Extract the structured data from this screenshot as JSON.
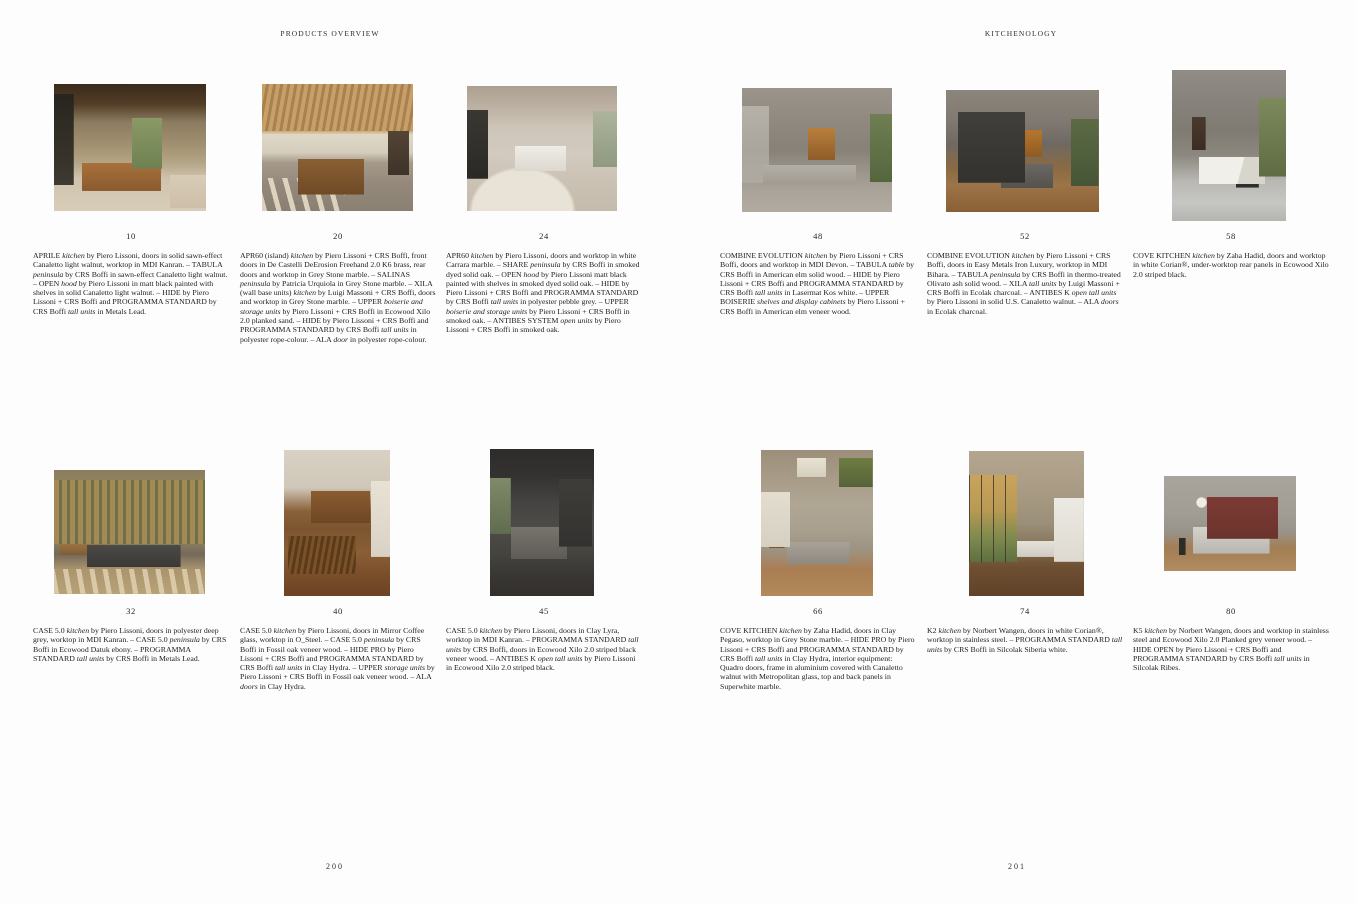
{
  "spread": {
    "page_left": {
      "header": "PRODUCTS OVERVIEW",
      "page_number": "200",
      "items": [
        {
          "number": "10",
          "photo_desc": "kitchen with dark wood ceiling, walnut island, greenery through window",
          "caption": [
            {
              "t": "APRILE "
            },
            {
              "t": "kitchen",
              "i": true
            },
            {
              "t": " by Piero Lissoni, doors in solid sawn-effect Canaletto light walnut, worktop in MDI Kanran. – TABULA "
            },
            {
              "t": "peninsula",
              "i": true
            },
            {
              "t": " by CRS Boffi in sawn-effect Canaletto light walnut. – OPEN "
            },
            {
              "t": "hood",
              "i": true
            },
            {
              "t": " by Piero Lissoni in matt black painted with shelves in solid Canaletto light walnut. – HIDE by Piero Lissoni + CRS Boffi and PROGRAMMA STANDARD by CRS Boffi "
            },
            {
              "t": "tall units",
              "i": true
            },
            {
              "t": " in Metals Lead."
            }
          ]
        },
        {
          "number": "20",
          "photo_desc": "kitchen under wooden slat ceiling with stone island and sunlit floor",
          "caption": [
            {
              "t": "APR60 (island) "
            },
            {
              "t": "kitchen",
              "i": true
            },
            {
              "t": " by Piero Lissoni + CRS Boffi, front doors in De Castelli DeErosion Freehand 2.0 K6 brass, rear doors and worktop in Grey Stone marble. – SALINAS "
            },
            {
              "t": "peninsula",
              "i": true
            },
            {
              "t": " by Patricia Urquiola in Grey Stone marble. – XILA (wall base units) "
            },
            {
              "t": "kitchen",
              "i": true
            },
            {
              "t": " by Luigi Massoni + CRS Boffi, doors and worktop in Grey Stone marble. – UPPER "
            },
            {
              "t": "boiserie and storage units",
              "i": true
            },
            {
              "t": " by Piero Lissoni + CRS Boffi in Ecowood Xilo 2.0 planked sand. – HIDE by Piero Lissoni + CRS Boffi and PROGRAMMA STANDARD by CRS Boffi "
            },
            {
              "t": "tall units",
              "i": true
            },
            {
              "t": " in polyester rope-colour. – ALA "
            },
            {
              "t": "door",
              "i": true
            },
            {
              "t": " in polyester rope-colour."
            }
          ]
        },
        {
          "number": "24",
          "photo_desc": "living kitchen in white Carrara marble with curved cream sofas",
          "caption": [
            {
              "t": "APR60 "
            },
            {
              "t": "kitchen",
              "i": true
            },
            {
              "t": " by Piero Lissoni, doors and worktop in white Carrara marble. – SHARE "
            },
            {
              "t": "peninsula",
              "i": true
            },
            {
              "t": " by CRS Boffi in smoked dyed solid oak. – OPEN "
            },
            {
              "t": "hood",
              "i": true
            },
            {
              "t": " by Piero Lissoni matt black painted with shelves in smoked dyed solid oak. – HIDE by Piero Lissoni + CRS Boffi and PROGRAMMA STANDARD by CRS Boffi "
            },
            {
              "t": "tall units",
              "i": true
            },
            {
              "t": " in polyester pebble grey. – UPPER "
            },
            {
              "t": "boiserie and storage units",
              "i": true
            },
            {
              "t": " by Piero Lissoni + CRS Boffi in smoked oak. – ANTIBES SYSTEM "
            },
            {
              "t": "open units",
              "i": true
            },
            {
              "t": " by Piero Lissoni + CRS Boffi in smoked oak."
            }
          ]
        },
        {
          "number": "32",
          "photo_desc": "kitchen behind wooden slat screens with greenery and dark island",
          "caption": [
            {
              "t": "CASE 5.0 "
            },
            {
              "t": "kitchen",
              "i": true
            },
            {
              "t": " by Piero Lissoni, doors in polyester deep grey, worktop in MDI Kanran. – CASE 5.0 "
            },
            {
              "t": "peninsula",
              "i": true
            },
            {
              "t": " by CRS Boffi in Ecowood Datuk ebony. – PROGRAMMA STANDARD "
            },
            {
              "t": "tall units",
              "i": true
            },
            {
              "t": " by CRS Boffi in Metals Lead."
            }
          ]
        },
        {
          "number": "40",
          "photo_desc": "kitchen with cream cabinets, open warm-lit shelves and striped oak peninsula",
          "caption": [
            {
              "t": "CASE 5.0 "
            },
            {
              "t": "kitchen",
              "i": true
            },
            {
              "t": " by Piero Lissoni, doors in Mirror Coffee glass, worktop in O_Steel. – CASE 5.0 "
            },
            {
              "t": "peninsula",
              "i": true
            },
            {
              "t": " by CRS Boffi in Fossil oak veneer wood. – HIDE PRO by Piero Lissoni + CRS Boffi and PROGRAMMA STANDARD by CRS Boffi "
            },
            {
              "t": "tall units",
              "i": true
            },
            {
              "t": " in Clay Hydra. – UPPER "
            },
            {
              "t": "storage units",
              "i": true
            },
            {
              "t": " by Piero Lissoni + CRS Boffi in Fossil oak veneer wood. – ALA "
            },
            {
              "t": "doors",
              "i": true
            },
            {
              "t": " in Clay Hydra."
            }
          ]
        },
        {
          "number": "45",
          "photo_desc": "dark grey kitchen with island, shelving wall and side window",
          "caption": [
            {
              "t": "CASE 5.0 "
            },
            {
              "t": "kitchen",
              "i": true
            },
            {
              "t": " by Piero Lissoni, doors in Clay Lyra, worktop in MDI Kanran. – PROGRAMMA STANDARD "
            },
            {
              "t": "tall units",
              "i": true
            },
            {
              "t": " by CRS Boffi, doors in Ecowood Xilo 2.0 striped black veneer wood. – ANTIBES K "
            },
            {
              "t": "open tall units",
              "i": true
            },
            {
              "t": " by Piero Lissoni in Ecowood Xilo 2.0 striped black."
            }
          ]
        }
      ]
    },
    "page_right": {
      "header": "KITCHENOLOGY",
      "page_number": "201",
      "items": [
        {
          "number": "48",
          "photo_desc": "concrete-ceiling kitchen with elm shelf wall, grey island and plant",
          "caption": [
            {
              "t": "COMBINE EVOLUTION "
            },
            {
              "t": "kitchen",
              "i": true
            },
            {
              "t": " by Piero Lissoni + CRS Boffi, doors and worktop in MDI Devon. – TABULA "
            },
            {
              "t": "table",
              "i": true
            },
            {
              "t": " by CRS Boffi in American elm solid wood. – HIDE by Piero Lissoni + CRS Boffi and PROGRAMMA STANDARD by CRS Boffi "
            },
            {
              "t": "tall units",
              "i": true
            },
            {
              "t": " in Lasermat Kos white. – UPPER BOISERIE "
            },
            {
              "t": "shelves and display cabinets",
              "i": true
            },
            {
              "t": " by Piero Lissoni + CRS Boffi in American elm veneer wood."
            }
          ]
        },
        {
          "number": "52",
          "photo_desc": "charcoal kitchen cabinets with glowing shelf niche and sunlit wood floor",
          "caption": [
            {
              "t": "COMBINE EVOLUTION "
            },
            {
              "t": "kitchen",
              "i": true
            },
            {
              "t": " by Piero Lissoni + CRS Boffi, doors in Easy Metals Iron Luxury, worktop in MDI Bihara. – TABULA "
            },
            {
              "t": "peninsula",
              "i": true
            },
            {
              "t": " by CRS Boffi in thermo-treated Olivato ash solid wood. – XILA "
            },
            {
              "t": "tall units",
              "i": true
            },
            {
              "t": " by Luigi Massoni + CRS Boffi in Ecolak charcoal. – ANTIBES K "
            },
            {
              "t": "open tall units",
              "i": true
            },
            {
              "t": " by Piero Lissoni in solid U.S. Canaletto walnut. – ALA "
            },
            {
              "t": "doors",
              "i": true
            },
            {
              "t": " in Ecolak charcoal."
            }
          ]
        },
        {
          "number": "58",
          "photo_desc": "sculptural white Corian island under concrete ceiling with courtyard greenery",
          "caption": [
            {
              "t": "COVE KITCHEN "
            },
            {
              "t": "kitchen",
              "i": true
            },
            {
              "t": " by Zaha Hadid, doors and worktop in white Corian®, under-worktop rear panels in Ecowood Xilo 2.0 striped black."
            }
          ]
        },
        {
          "number": "66",
          "photo_desc": "curved concrete interior with grey stone island, wood floor and hanging plants",
          "caption": [
            {
              "t": "COVE KITCHEN "
            },
            {
              "t": "kitchen",
              "i": true
            },
            {
              "t": " by Zaha Hadid, doors in Clay Pegaso, worktop in Grey Stone marble. – HIDE PRO by Piero Lissoni + CRS Boffi and PROGRAMMA STANDARD by CRS Boffi "
            },
            {
              "t": "tall units",
              "i": true
            },
            {
              "t": " in Clay Hydra, interior equipment: Quadro doors, frame in aluminium covered with Canaletto walnut with Metropolitan glass, top and back panels in Superwhite marble."
            }
          ]
        },
        {
          "number": "74",
          "photo_desc": "white island kitchen beside full-height windows with autumn trees",
          "caption": [
            {
              "t": "K2 "
            },
            {
              "t": "kitchen",
              "i": true
            },
            {
              "t": " by Norbert Wangen, doors in white Corian®, worktop in stainless steel. – PROGRAMMA STANDARD "
            },
            {
              "t": "tall units",
              "i": true
            },
            {
              "t": " by CRS Boffi in Silcolak Siberia white."
            }
          ]
        },
        {
          "number": "80",
          "photo_desc": "steel island with burgundy tall cabinets, globe pendant and wood floor",
          "caption": [
            {
              "t": "K5 "
            },
            {
              "t": "kitchen",
              "i": true
            },
            {
              "t": " by Norbert Wangen, doors and worktop in stainless steel and Ecowood Xilo 2.0 Planked grey veneer wood. – HIDE OPEN by Piero Lissoni + CRS Boffi and PROGRAMMA STANDARD by CRS Boffi "
            },
            {
              "t": "tall units",
              "i": true
            },
            {
              "t": " in Silcolak Ribes."
            }
          ]
        }
      ]
    }
  }
}
